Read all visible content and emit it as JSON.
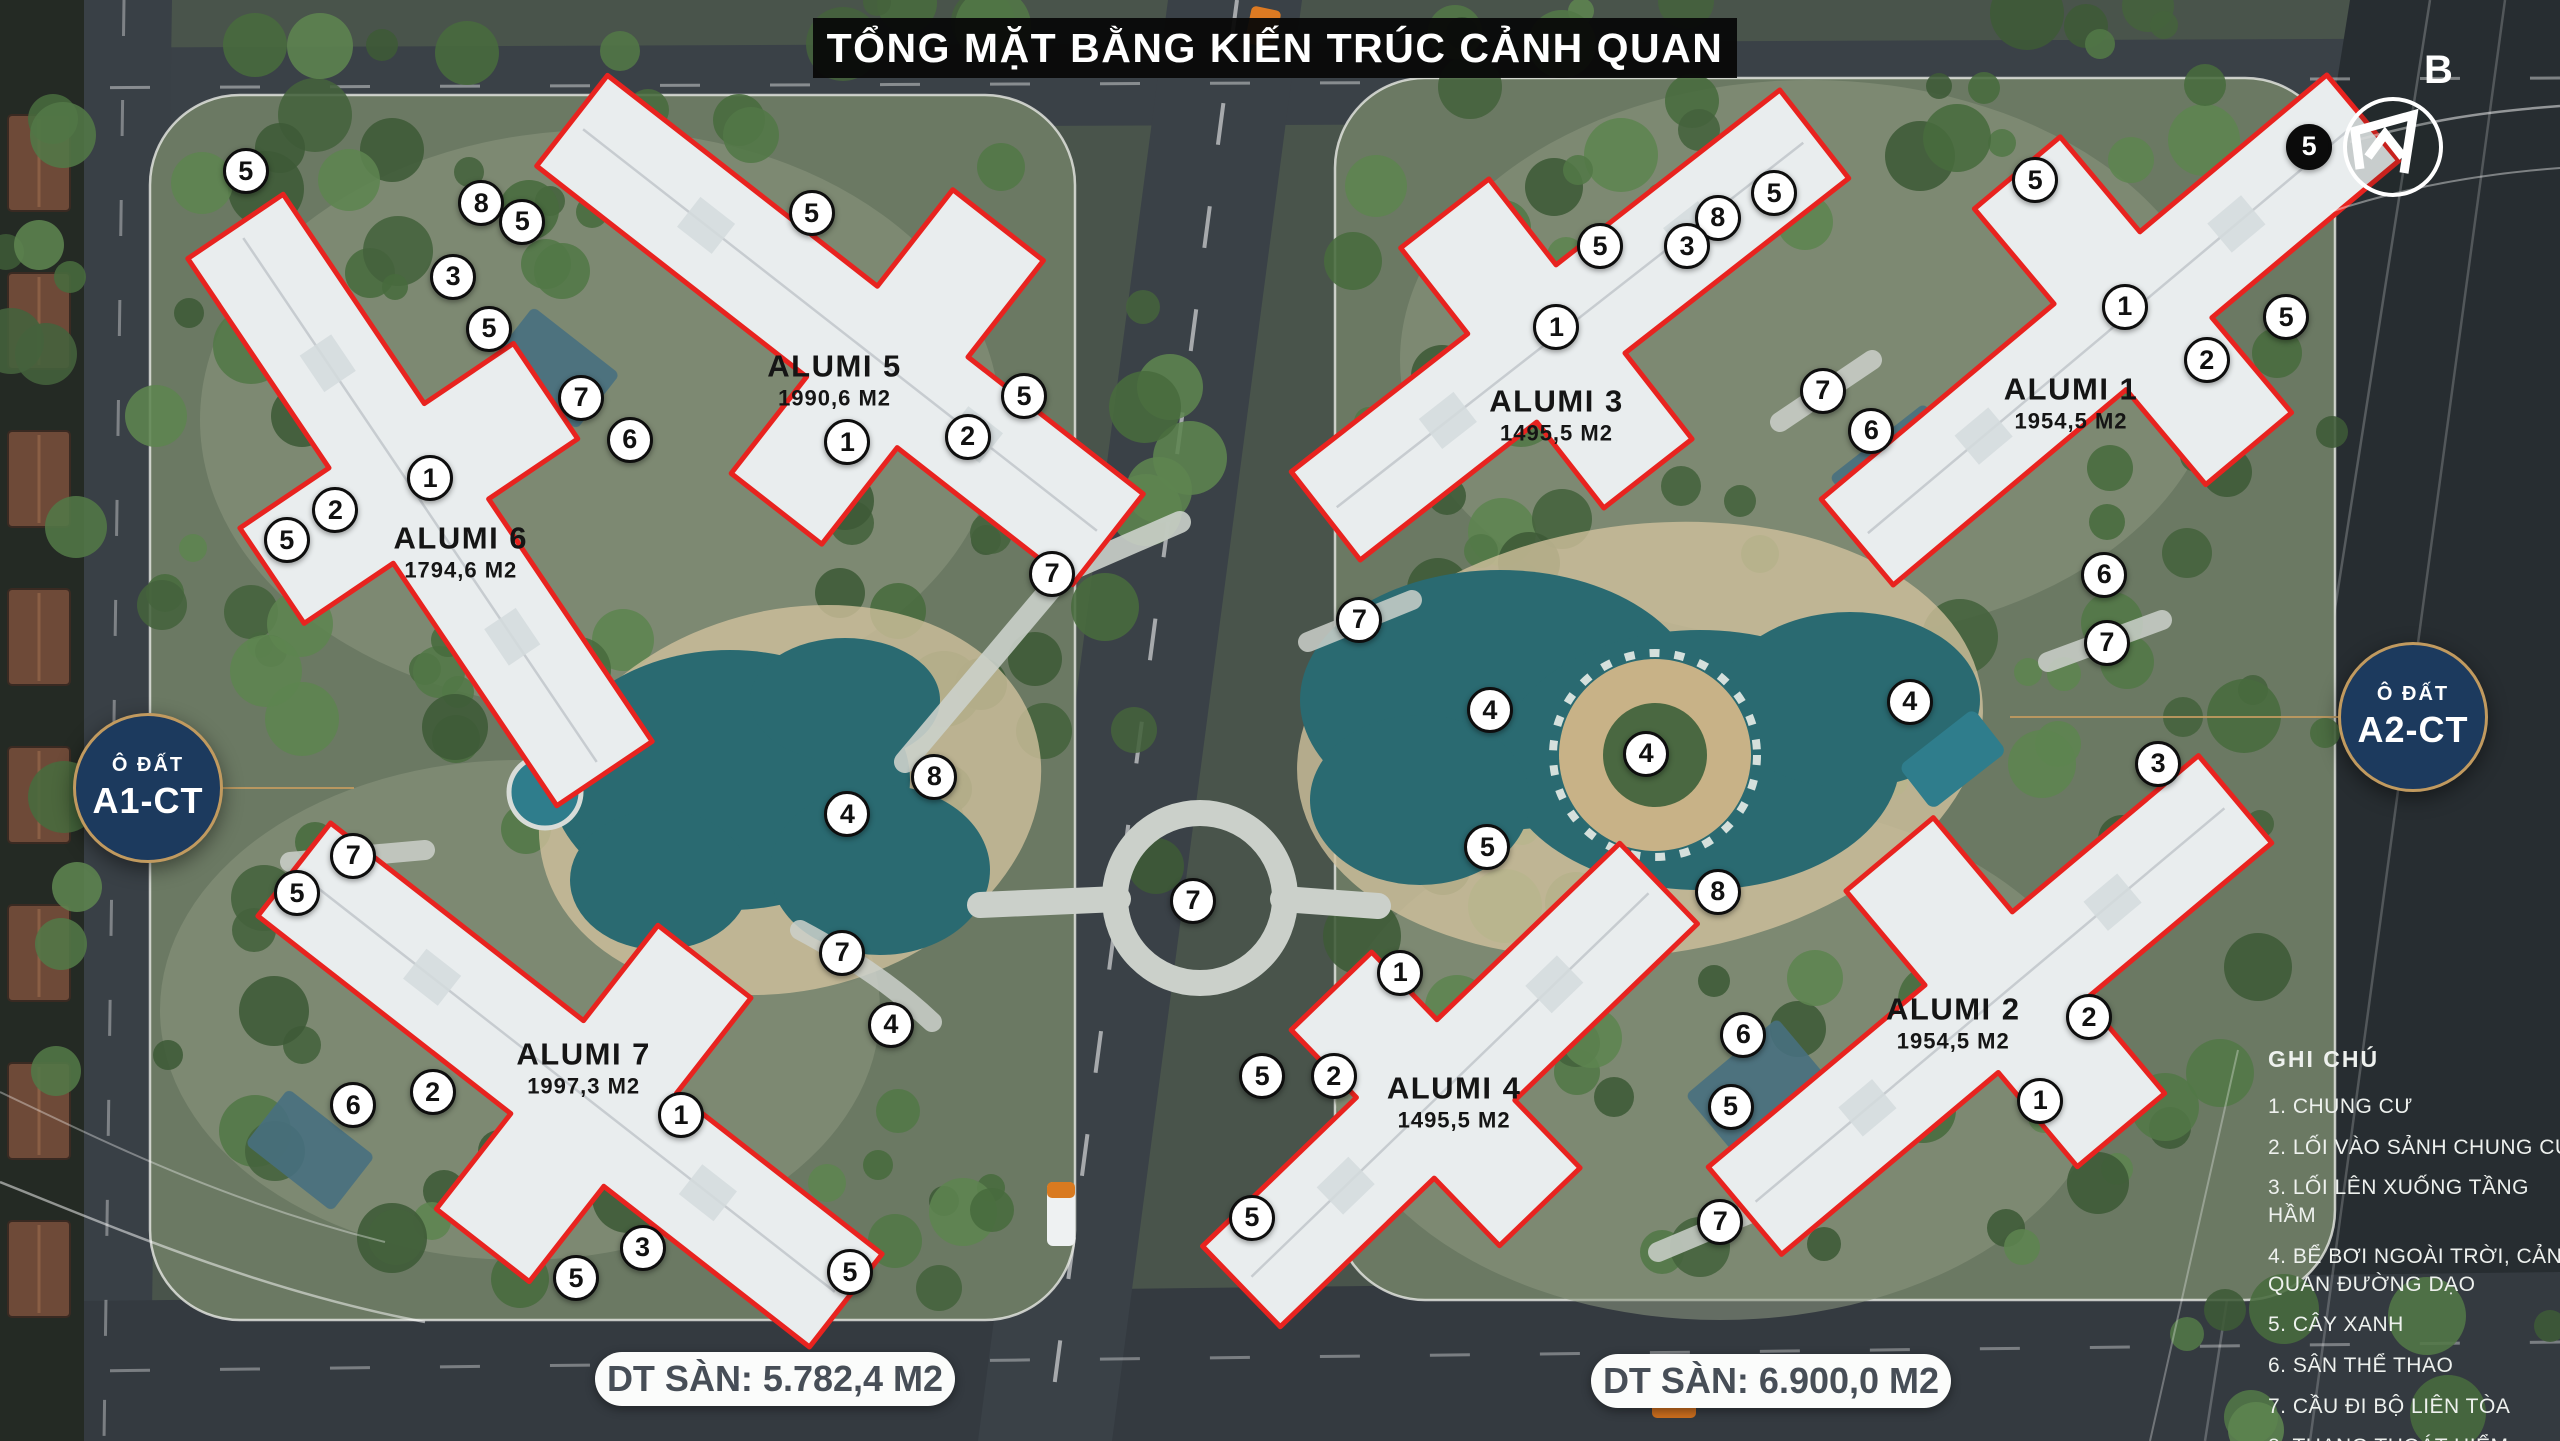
{
  "title": "TỔNG MẶT BẰNG KIẾN TRÚC CẢNH QUAN",
  "north": {
    "label": "B"
  },
  "plots": [
    {
      "tag_line1": "Ô ĐẤT",
      "tag_line2": "A1-CT",
      "floor_area_label": "DT SÀN: 5.782,4 M2"
    },
    {
      "tag_line1": "Ô ĐẤT",
      "tag_line2": "A2-CT",
      "floor_area_label": "DT SÀN: 6.900,0 M2"
    }
  ],
  "buildings": [
    {
      "name": "ALUMI 5",
      "area": "1990,6 M2",
      "x": 32.6,
      "y": 26.4
    },
    {
      "name": "ALUMI 6",
      "area": "1794,6 M2",
      "x": 18.0,
      "y": 38.3
    },
    {
      "name": "ALUMI 7",
      "area": "1997,3 M2",
      "x": 22.8,
      "y": 74.1
    },
    {
      "name": "ALUMI 3",
      "area": "1495,5 M2",
      "x": 60.8,
      "y": 28.8
    },
    {
      "name": "ALUMI 1",
      "area": "1954,5 M2",
      "x": 80.9,
      "y": 28.0
    },
    {
      "name": "ALUMI 4",
      "area": "1495,5 M2",
      "x": 56.8,
      "y": 76.5
    },
    {
      "name": "ALUMI 2",
      "area": "1954,5 M2",
      "x": 76.3,
      "y": 71.0
    }
  ],
  "legend": {
    "title": "GHI CHÚ",
    "items": [
      "1. CHUNG CƯ",
      "2. LỐI VÀO SẢNH CHUNG CƯ",
      "3. LỐI LÊN XUỐNG TẦNG HẦM",
      "4. BỂ BƠI NGOÀI TRỜI, CẢNH QUAN ĐƯỜNG DẠO",
      "5. CÂY XANH",
      "6. SÂN THỂ THAO",
      "7. CẦU ĐI BỘ LIÊN TÒA",
      "8. THANG THOÁT HIỂM"
    ]
  },
  "markers": [
    {
      "n": 5,
      "x": 9.6,
      "y": 11.9
    },
    {
      "n": 8,
      "x": 18.8,
      "y": 14.1
    },
    {
      "n": 5,
      "x": 20.4,
      "y": 15.4
    },
    {
      "n": 3,
      "x": 17.7,
      "y": 19.2
    },
    {
      "n": 5,
      "x": 19.1,
      "y": 22.8
    },
    {
      "n": 5,
      "x": 31.7,
      "y": 14.8
    },
    {
      "n": 7,
      "x": 22.7,
      "y": 27.6
    },
    {
      "n": 6,
      "x": 24.6,
      "y": 30.5
    },
    {
      "n": 1,
      "x": 33.1,
      "y": 30.7
    },
    {
      "n": 2,
      "x": 37.8,
      "y": 30.3
    },
    {
      "n": 5,
      "x": 40.0,
      "y": 27.5
    },
    {
      "n": 1,
      "x": 16.8,
      "y": 33.2
    },
    {
      "n": 2,
      "x": 13.1,
      "y": 35.4
    },
    {
      "n": 5,
      "x": 11.2,
      "y": 37.5
    },
    {
      "n": 7,
      "x": 41.1,
      "y": 39.8
    },
    {
      "n": 8,
      "x": 36.5,
      "y": 53.9
    },
    {
      "n": 4,
      "x": 33.1,
      "y": 56.5
    },
    {
      "n": 7,
      "x": 13.8,
      "y": 59.4
    },
    {
      "n": 5,
      "x": 11.6,
      "y": 62.0
    },
    {
      "n": 7,
      "x": 32.9,
      "y": 66.1
    },
    {
      "n": 4,
      "x": 34.8,
      "y": 71.1
    },
    {
      "n": 2,
      "x": 16.9,
      "y": 75.8
    },
    {
      "n": 6,
      "x": 13.8,
      "y": 76.7
    },
    {
      "n": 1,
      "x": 26.6,
      "y": 77.4
    },
    {
      "n": 3,
      "x": 25.1,
      "y": 86.6
    },
    {
      "n": 5,
      "x": 22.5,
      "y": 88.7
    },
    {
      "n": 5,
      "x": 33.2,
      "y": 88.3
    },
    {
      "n": 7,
      "x": 46.6,
      "y": 62.5
    },
    {
      "n": 5,
      "x": 69.3,
      "y": 13.4
    },
    {
      "n": 8,
      "x": 67.1,
      "y": 15.1
    },
    {
      "n": 3,
      "x": 65.9,
      "y": 17.1
    },
    {
      "n": 5,
      "x": 62.5,
      "y": 17.1
    },
    {
      "n": 1,
      "x": 60.8,
      "y": 22.7
    },
    {
      "n": 5,
      "x": 79.5,
      "y": 12.5
    },
    {
      "n": 1,
      "x": 83.0,
      "y": 21.3
    },
    {
      "n": 2,
      "x": 86.2,
      "y": 25.0
    },
    {
      "n": 5,
      "x": 89.3,
      "y": 22.0
    },
    {
      "n": 7,
      "x": 71.2,
      "y": 27.1
    },
    {
      "n": 6,
      "x": 73.1,
      "y": 29.9
    },
    {
      "n": 6,
      "x": 82.2,
      "y": 39.9
    },
    {
      "n": 7,
      "x": 82.3,
      "y": 44.6
    },
    {
      "n": 3,
      "x": 84.3,
      "y": 53.0
    },
    {
      "n": 4,
      "x": 74.6,
      "y": 48.7
    },
    {
      "n": 4,
      "x": 64.3,
      "y": 52.3
    },
    {
      "n": 4,
      "x": 58.2,
      "y": 49.3
    },
    {
      "n": 7,
      "x": 53.1,
      "y": 43.0
    },
    {
      "n": 5,
      "x": 58.1,
      "y": 58.8
    },
    {
      "n": 8,
      "x": 67.1,
      "y": 61.9
    },
    {
      "n": 1,
      "x": 54.7,
      "y": 67.5
    },
    {
      "n": 2,
      "x": 81.6,
      "y": 70.6
    },
    {
      "n": 1,
      "x": 79.7,
      "y": 76.4
    },
    {
      "n": 6,
      "x": 68.1,
      "y": 71.8
    },
    {
      "n": 5,
      "x": 49.3,
      "y": 74.7
    },
    {
      "n": 2,
      "x": 52.1,
      "y": 74.7
    },
    {
      "n": 5,
      "x": 67.6,
      "y": 76.8
    },
    {
      "n": 7,
      "x": 67.2,
      "y": 84.8
    },
    {
      "n": 5,
      "x": 48.9,
      "y": 84.5
    },
    {
      "n": 5,
      "x": 90.2,
      "y": 10.2,
      "style": "dark"
    }
  ],
  "colors": {
    "building_outline": "#e8231f",
    "badge_navy": "#1c3a5e",
    "badge_gold": "#c19a5f",
    "pool_teal": "#2a6a71",
    "title_bg": "#0a0a0a",
    "marker_light_bg": "#ffffff",
    "marker_dark_bg": "#0b0b0b"
  }
}
